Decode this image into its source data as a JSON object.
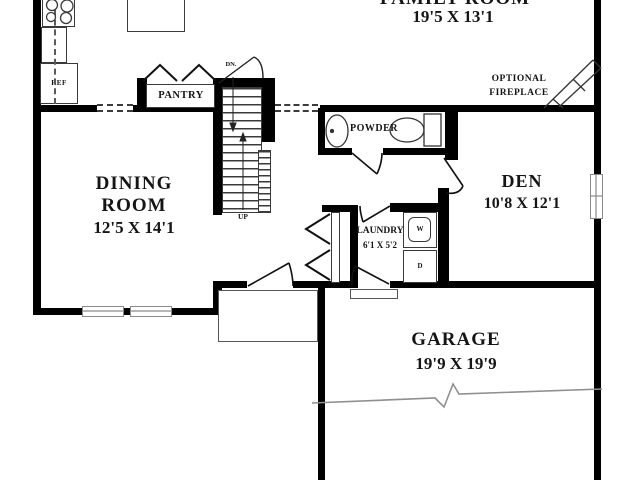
{
  "rooms": {
    "family": {
      "name": "FAMILY ROOM",
      "dims": "19'5 X 13'1"
    },
    "dining": {
      "line1": "DINING",
      "line2": "ROOM",
      "dims": "12'5 X 14'1"
    },
    "den": {
      "name": "DEN",
      "dims": "10'8 X 12'1"
    },
    "garage": {
      "name": "GARAGE",
      "dims": "19'9 X 19'9"
    },
    "laundry": {
      "name": "LAUNDRY",
      "dims": "6'1 X 5'2"
    },
    "powder": {
      "name": "POWDER"
    },
    "pantry": {
      "name": "PANTRY"
    }
  },
  "fixtures": {
    "refrigerator": "REF",
    "washer": "W",
    "dryer": "D"
  },
  "stairs": {
    "down": "DN.",
    "up": "UP"
  },
  "annotations": {
    "fireplace_line1": "OPTIONAL",
    "fireplace_line2": "FIREPLACE"
  },
  "colors": {
    "wall": "#000000",
    "fixture_line": "#3a3a3a",
    "window": "#8a8a8a",
    "text": "#151515",
    "background": "#ffffff"
  }
}
